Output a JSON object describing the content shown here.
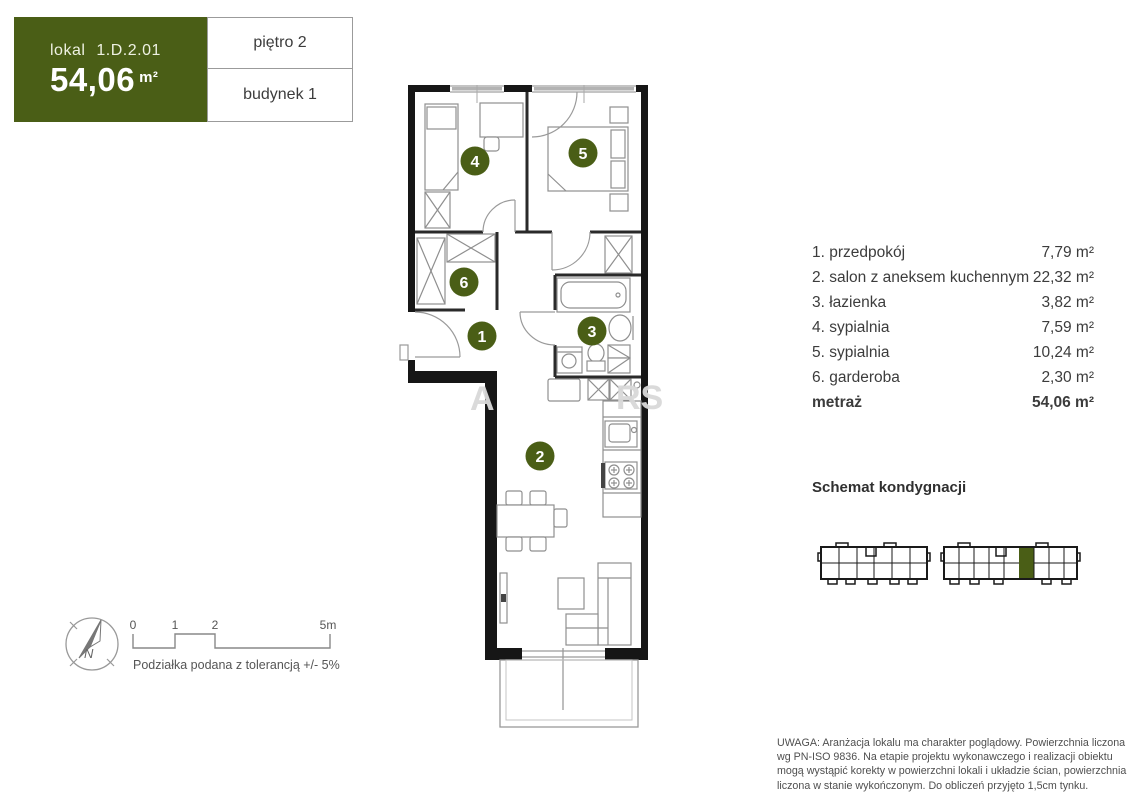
{
  "unit_card": {
    "lokal_label": "lokal",
    "lokal_id": "1.D.2.01",
    "area_value": "54,06",
    "area_unit": "m²",
    "floor_label": "piętro 2",
    "building_label": "budynek 1"
  },
  "room_list": {
    "items": [
      {
        "num": "1",
        "label": "1. przedpokój",
        "area": "7,79 m²"
      },
      {
        "num": "2",
        "label": "2. salon z aneksem kuchennym",
        "area": "22,32 m²"
      },
      {
        "num": "3",
        "label": "3. łazienka",
        "area": "3,82 m²"
      },
      {
        "num": "4",
        "label": "4. sypialnia",
        "area": "7,59 m²"
      },
      {
        "num": "5",
        "label": "5. sypialnia",
        "area": "10,24 m²"
      },
      {
        "num": "6",
        "label": "6. garderoba",
        "area": "2,30 m²"
      }
    ],
    "total_label": "metraż",
    "total_area": "54,06 m²"
  },
  "floor_schematic": {
    "title": "Schemat kondygnacji"
  },
  "scale": {
    "tick0": "0",
    "tick1": "1",
    "tick2": "2",
    "tick3": "5m",
    "tolerance_note": "Podziałka podana z tolerancją +/- 5%",
    "compass_n": "N"
  },
  "watermark": {
    "fragment1": "A",
    "fragment2": "RS"
  },
  "disclaimer": "UWAGA: Aranżacja lokalu ma charakter poglądowy. Powierzchnia liczona wg PN-ISO 9836. Na etapie projektu wykonawczego i realizacji obiektu mogą wystąpić korekty w powierzchni lokali i układzie ścian, powierzchnia liczona w stanie wykończonym. Do obliczeń przyjęto 1,5cm tynku.",
  "colors": {
    "accent_green": "#4a5e16",
    "wall": "#161616"
  }
}
